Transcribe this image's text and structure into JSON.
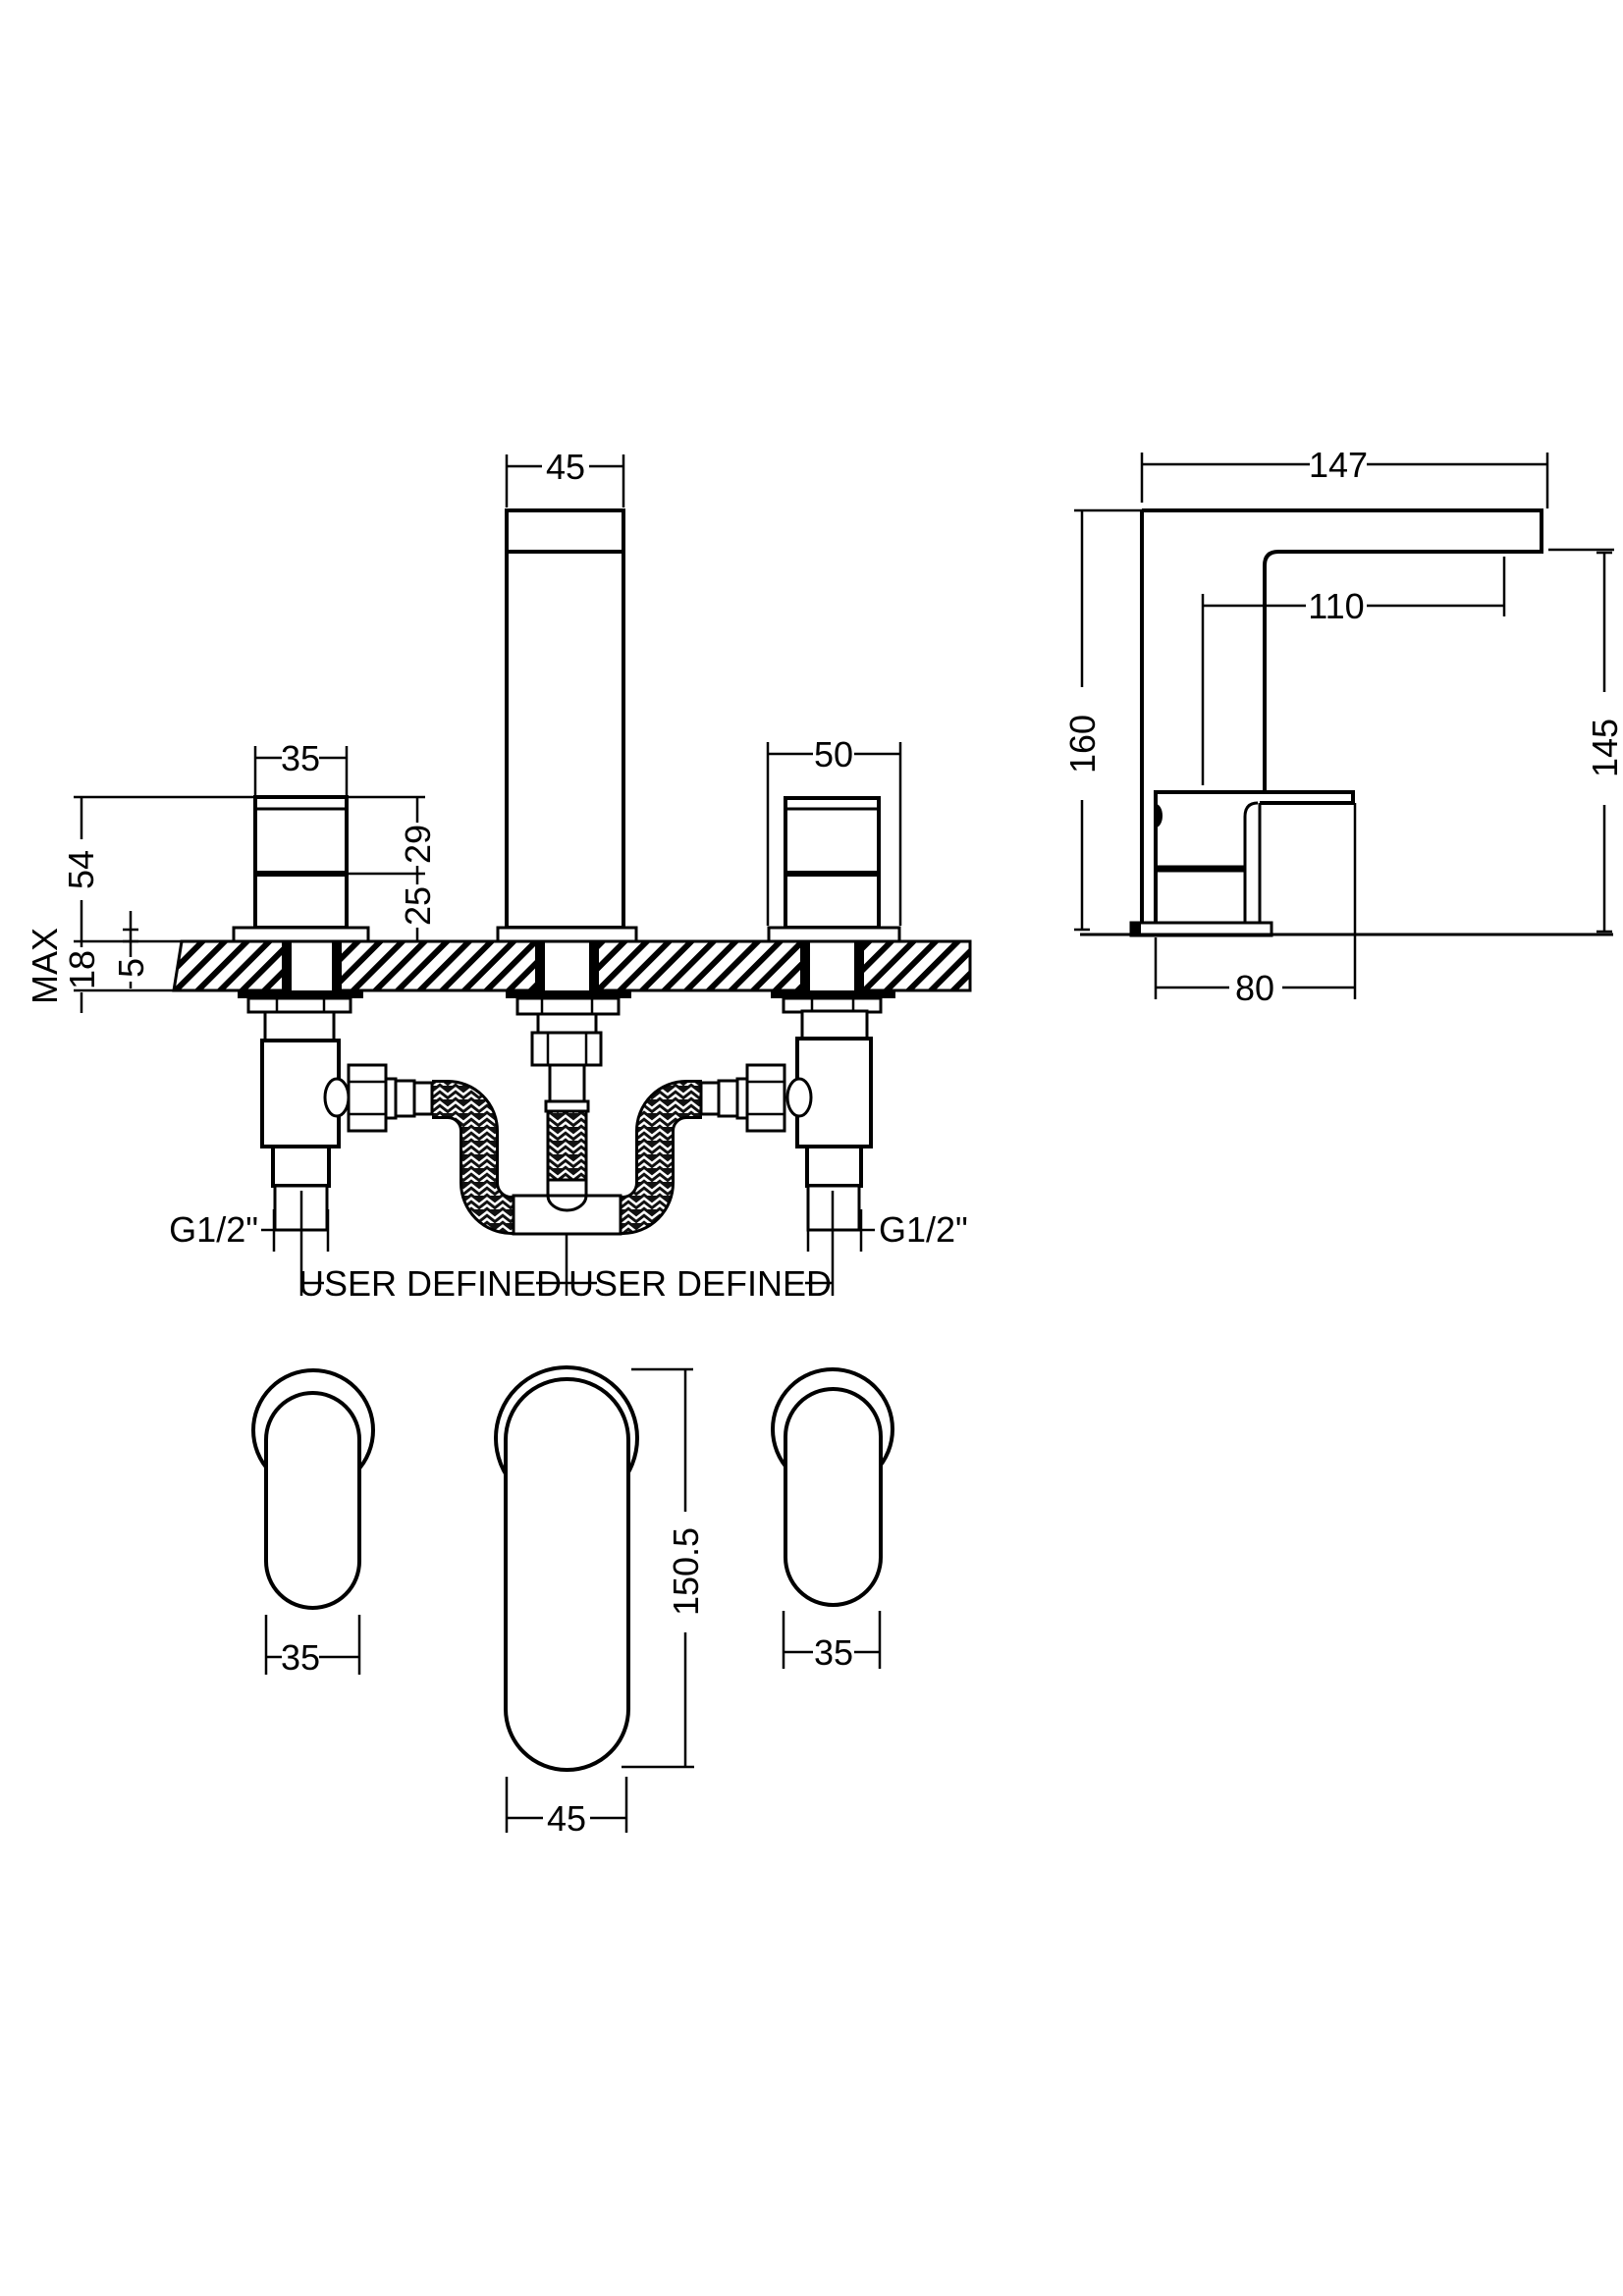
{
  "drawing": {
    "colors": {
      "line": "#000000",
      "background": "#ffffff",
      "hose_fill": "#111111"
    },
    "front_view": {
      "spout_width": "45",
      "left_handle_width": "35",
      "right_handle_width": "50",
      "height_above_deck": "54",
      "handle_top_to_split": "29",
      "split_to_deck": "25",
      "deck_thickness": "18",
      "deck_thickness_qualifier": "MAX",
      "base_plate_height": "5",
      "left_thread": "G1/2\"",
      "right_thread": "G1/2\"",
      "left_hose_length": "USER DEFINED",
      "right_hose_length": "USER DEFINED"
    },
    "side_view": {
      "total_reach": "147",
      "spout_reach": "110",
      "total_height": "160",
      "spout_height": "145",
      "body_depth": "80"
    },
    "plan_view": {
      "left_handle_width": "35",
      "spout_width": "45",
      "spout_length": "150.5",
      "right_handle_width": "35"
    }
  }
}
